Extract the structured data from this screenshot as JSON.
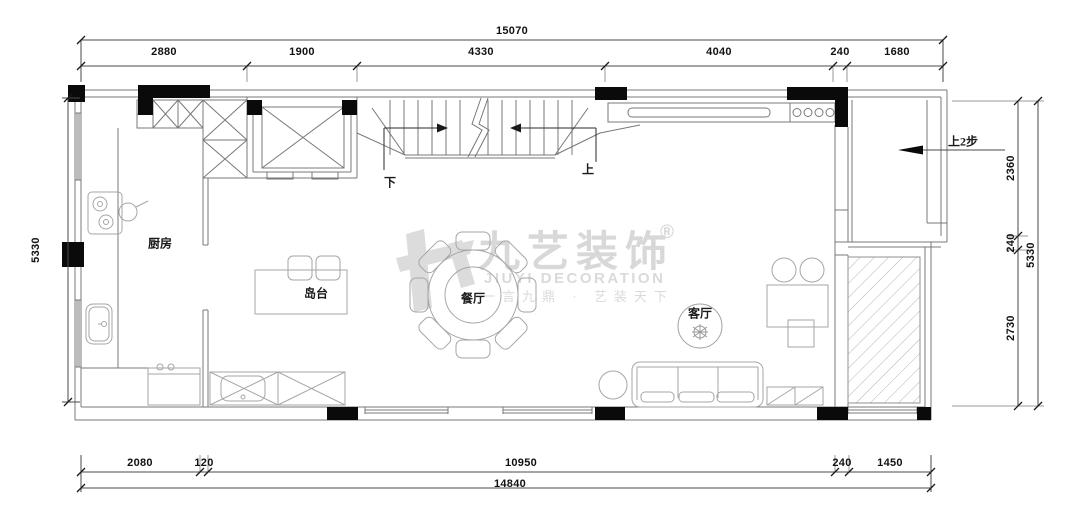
{
  "plan": {
    "rooms": {
      "kitchen": "厨房",
      "island": "岛台",
      "dining": "餐厅",
      "living": "客厅"
    },
    "stairs": {
      "down_label": "下",
      "up_label": "上"
    },
    "entry": {
      "note": "上2步"
    }
  },
  "dimensions": {
    "top": {
      "total": "15070",
      "segments": [
        "2880",
        "1900",
        "4330",
        "4040",
        "240",
        "1680"
      ]
    },
    "bottom": {
      "total": "14840",
      "segments": [
        "2080",
        "120",
        "10950",
        "240",
        "1450"
      ]
    },
    "left": {
      "total": "5330"
    },
    "right": {
      "total": "5330",
      "segments": [
        "2360",
        "240",
        "2730"
      ]
    }
  },
  "watermark": {
    "brand": "九艺装饰",
    "registered": "®",
    "brand_en": "JIUYI DECORATION",
    "slogan": "一言九鼎 · 艺装天下"
  },
  "colors": {
    "wall_line": "#787878",
    "furniture_line": "#a6a6a6",
    "solid_fill": "#0a0a0a",
    "dimension_line": "#4a4a4a",
    "watermark": "#d8d8d8"
  }
}
